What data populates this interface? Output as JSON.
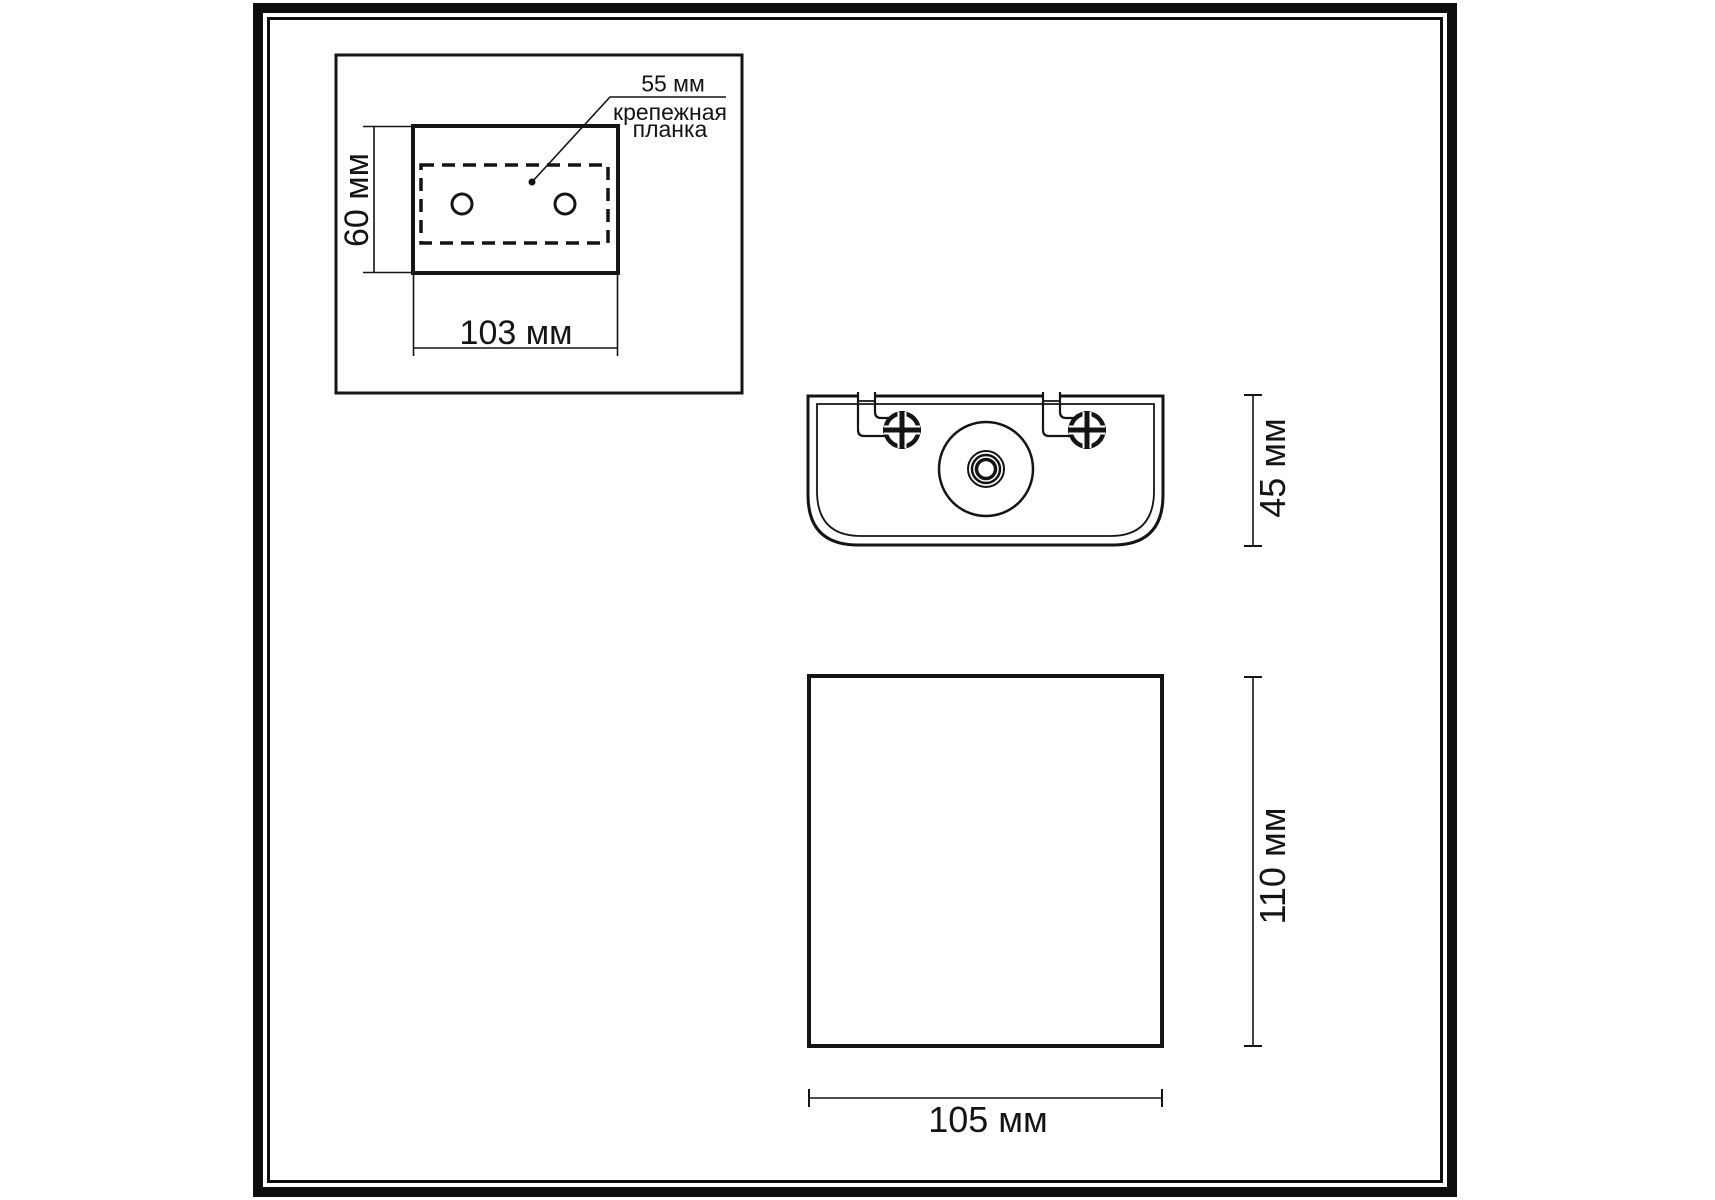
{
  "page": {
    "background": "#ffffff",
    "ink": "#141414",
    "frame_color": "#0d0d0d"
  },
  "inset": {
    "callout_dim": "55 мм",
    "callout_caption_line1": "крепежная",
    "callout_caption_line2": "планка",
    "height_dim": "60 мм",
    "width_dim": "103 мм"
  },
  "top_view": {
    "height_dim": "45 мм"
  },
  "front_view": {
    "height_dim": "110 мм",
    "width_dim": "105 мм"
  }
}
